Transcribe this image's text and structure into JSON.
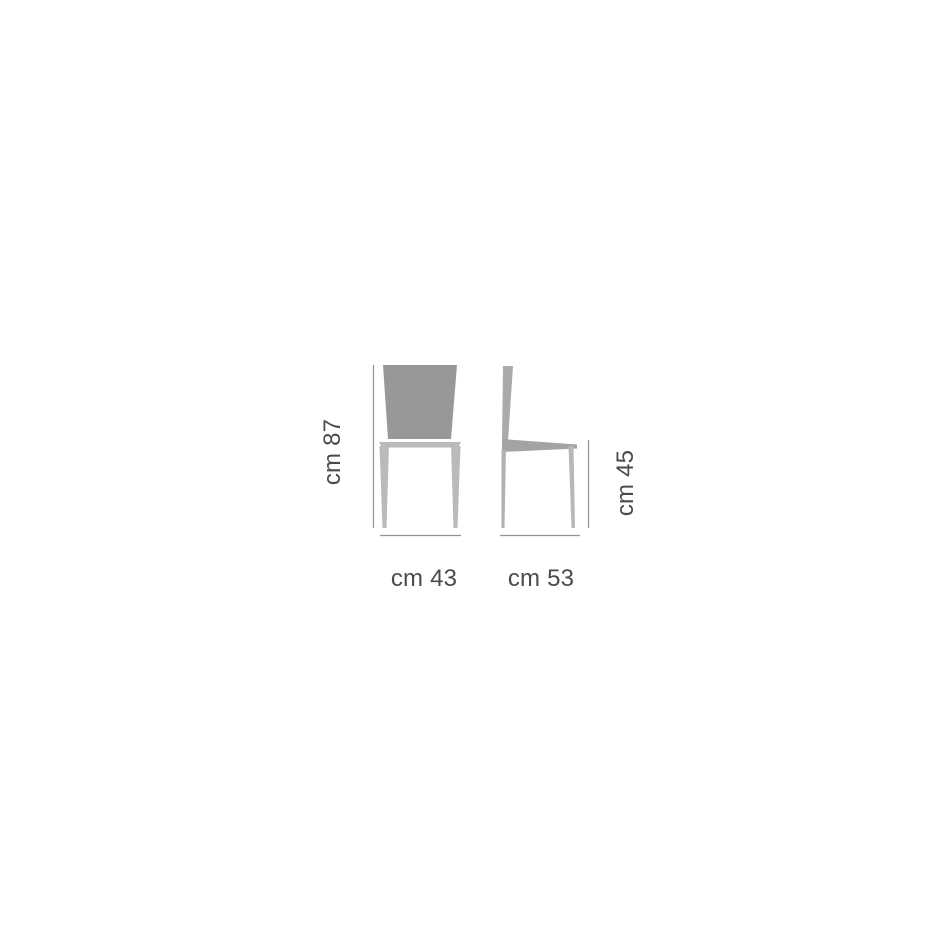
{
  "diagram": {
    "name": "chair-dimensions-diagram",
    "description": "Technical dimension drawing of a chair, front view and side view",
    "labels": {
      "height": "cm 87",
      "width": "cm 43",
      "depth": "cm 53",
      "seat_height": "cm 45"
    },
    "colors": {
      "background": "#ffffff",
      "backrest_front": "#98989a",
      "frame_front": "#bababc",
      "side_post": "#aaaaac",
      "side_seat": "#a3a3a5",
      "side_back_leg": "#b2b2b4",
      "side_front_leg": "#b8b8ba",
      "dimension_line": "#949496",
      "label_text": "#4b4b4d"
    }
  }
}
